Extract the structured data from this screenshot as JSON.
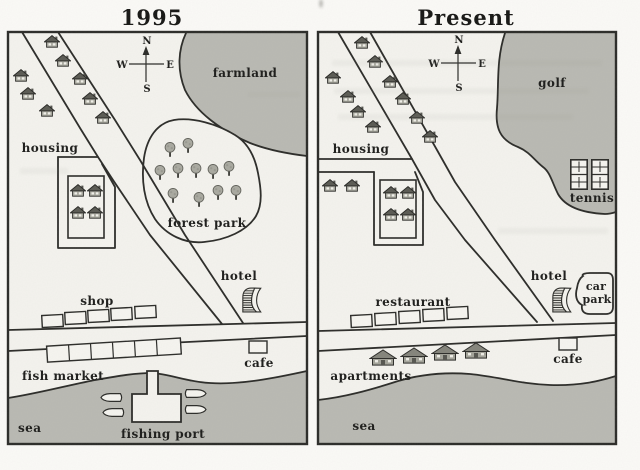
{
  "left_map": {
    "title": "1995",
    "compass": {
      "n": "N",
      "e": "E",
      "s": "S",
      "w": "W"
    },
    "labels": {
      "farmland": "farmland",
      "housing": "housing",
      "forest_park": "forest park",
      "hotel": "hotel",
      "shop": "shop",
      "cafe": "cafe",
      "fish_market": "fish market",
      "fishing_port": "fishing port",
      "sea": "sea"
    },
    "counts": {
      "roadside_houses": 8,
      "block_houses": 4,
      "trees": 11,
      "shop_units": 5,
      "fish_market_units": 6,
      "boats": 4
    }
  },
  "right_map": {
    "title": "Present",
    "compass": {
      "n": "N",
      "e": "E",
      "s": "S",
      "w": "W"
    },
    "labels": {
      "golf": "golf",
      "tennis": "tennis",
      "housing": "housing",
      "hotel": "hotel",
      "car_park_line1": "car",
      "car_park_line2": "park",
      "restaurant": "restaurant",
      "cafe": "cafe",
      "apartments": "apartments",
      "sea": "sea"
    },
    "counts": {
      "roadside_houses": 10,
      "detached_houses": 2,
      "block_houses": 4,
      "tennis_courts": 2,
      "restaurant_units": 5,
      "apartment_buildings": 4
    }
  },
  "colors": {
    "land_shade": "#b9b9b2",
    "paper": "#f4f3ee",
    "ink": "#2b2b28",
    "tree_canopy": "#a9a9a0"
  }
}
